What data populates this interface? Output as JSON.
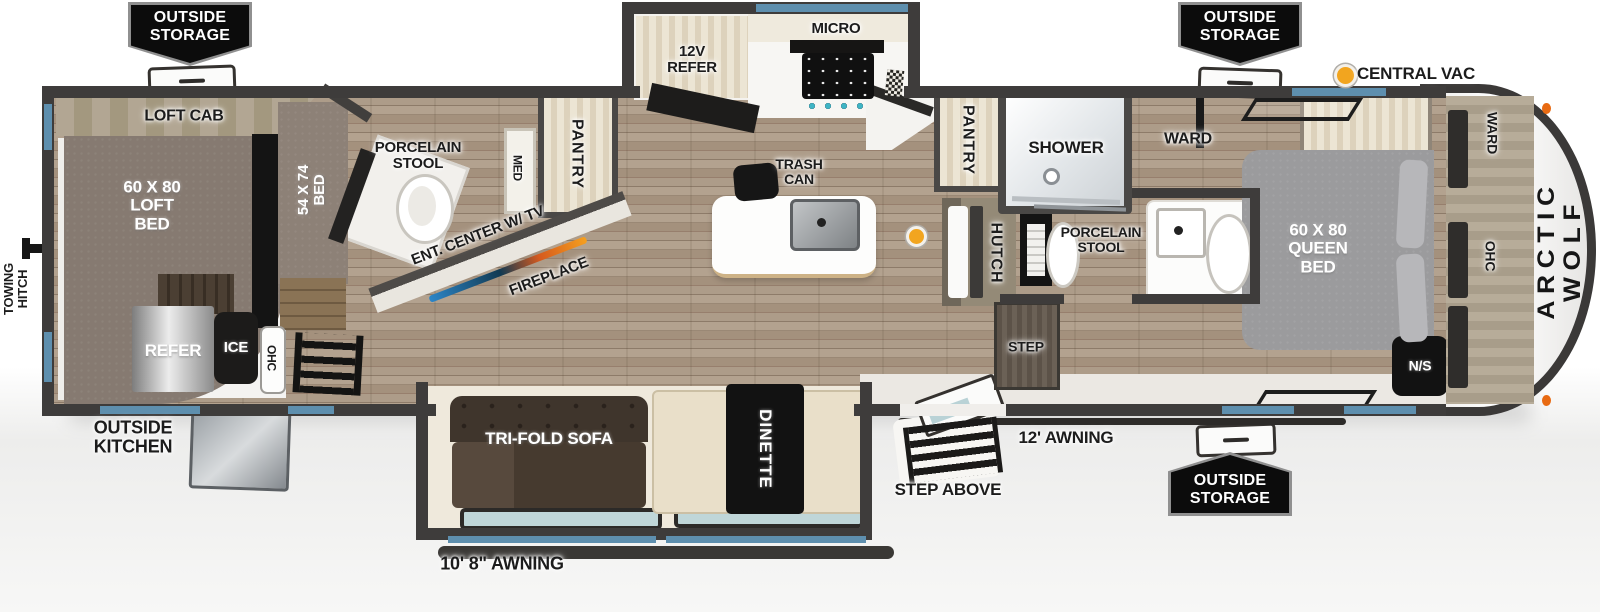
{
  "title": "Arctic Wolf travel trailer floor plan",
  "colors": {
    "wall": "#3e3c3b",
    "window_blue": "#5e8fae",
    "central_vac_yellow": "#f2a51f",
    "fireplace_gradient": [
      "#2c86c8",
      "#123a52",
      "#d65a1e",
      "#f5a01f"
    ],
    "badge_black": "#0c0c0c",
    "floor_wood": "#9a8875",
    "bed_gray": "#9b9b9d"
  },
  "legend": {
    "central_vac": "CENTRAL VAC"
  },
  "labels": {
    "outside_storage": "OUTSIDE\nSTORAGE",
    "towing_hitch": "TOWING\nHITCH",
    "outside_kitchen": "OUTSIDE\nKITCHEN",
    "step_above": "STEP ABOVE",
    "awning_main": "12' AWNING",
    "awning_slide": "10' 8\" AWNING",
    "brand": "ARCTIC WOLF",
    "loft_cab": "LOFT CAB",
    "loft_bed": "60 X 80\nLOFT\nBED",
    "bed_54": "54 X 74\nBED",
    "refer": "REFER",
    "ice": "ICE",
    "ohc_left": "OHC",
    "porcelain_stool_left": "PORCELAIN\nSTOOL",
    "med": "MED",
    "pantry_left": "PANTRY",
    "ent_center": "ENT. CENTER W/ TV",
    "fireplace": "FIREPLACE",
    "refer_12v": "12V\nREFER",
    "micro": "MICRO",
    "trash_can": "TRASH\nCAN",
    "pantry_right": "PANTRY",
    "hutch": "HUTCH",
    "shower": "SHOWER",
    "porcelain_stool_right": "PORCELAIN\nSTOOL",
    "ward_bath": "WARD",
    "step": "STEP",
    "queen_bed": "60 X 80\nQUEEN\nBED",
    "night_stand": "N/S",
    "ward_front": "WARD",
    "ohc_front": "OHC",
    "tri_fold_sofa": "TRI-FOLD SOFA",
    "dinette": "DINETTE"
  }
}
